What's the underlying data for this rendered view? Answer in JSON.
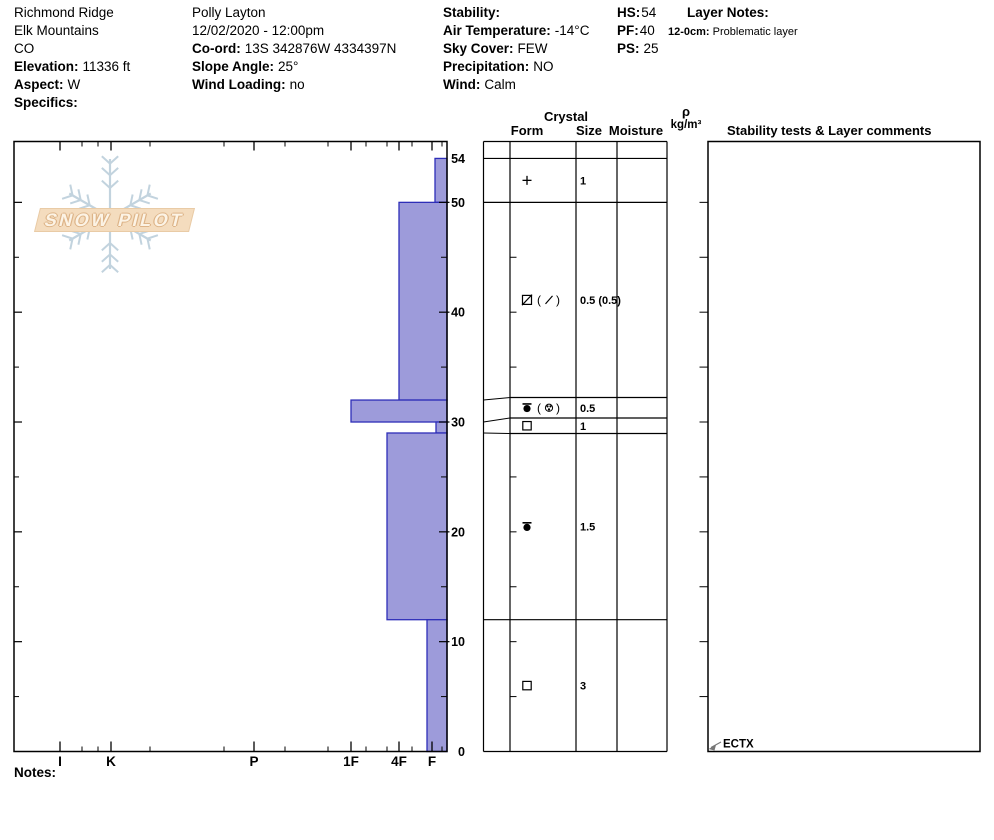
{
  "header": {
    "location": {
      "name": "Richmond Ridge",
      "range": "Elk Mountains",
      "state": "CO",
      "elevation_label": "Elevation:",
      "elevation": "11336 ft",
      "aspect_label": "Aspect:",
      "aspect": "W",
      "specifics_label": "Specifics:",
      "specifics": ""
    },
    "observer": {
      "name": "Polly Layton",
      "datetime": "12/02/2020 - 12:00pm",
      "coord_label": "Co-ord:",
      "coord": "13S 342876W 4334397N",
      "slope_angle_label": "Slope Angle:",
      "slope_angle": "25°",
      "wind_loading_label": "Wind Loading:",
      "wind_loading": "no"
    },
    "conditions": {
      "stability_label": "Stability:",
      "stability": "",
      "air_temp_label": "Air Temperature:",
      "air_temp": "-14°C",
      "sky_cover_label": "Sky Cover:",
      "sky_cover": "FEW",
      "precipitation_label": "Precipitation:",
      "precipitation": "NO",
      "wind_label": "Wind:",
      "wind": "Calm"
    },
    "snowpack": {
      "hs_label": "HS:",
      "hs": "54",
      "pf_label": "PF:",
      "pf": "40",
      "ps_label": "PS:",
      "ps": "25"
    },
    "layer_notes": {
      "title": "Layer Notes:",
      "notes": [
        {
          "range": "12-0cm:",
          "text": "Problematic layer"
        }
      ]
    }
  },
  "profile_table": {
    "crystal": "Crystal",
    "form": "Form",
    "size": "Size",
    "moisture": "Moisture",
    "rho": "ρ",
    "rho_units": "kg/m³",
    "stability_header": "Stability tests & Layer comments"
  },
  "footer": {
    "notes_label": "Notes:"
  },
  "logo": {
    "text": "SNOW PILOT"
  },
  "chart_data": {
    "type": "bar",
    "subtype": "snow-hardness-profile",
    "title": "",
    "xlabel": "Hand hardness (I K P 1F 4F F)",
    "ylabel": "Depth (cm)",
    "grid": false,
    "legend": false,
    "depth_axis": {
      "unit": "cm",
      "surface_cm": 54,
      "ground_cm": 0,
      "tick_labels": [
        "54",
        "50",
        "40",
        "30",
        "20",
        "10",
        "0"
      ],
      "minor_tick_step_cm": 5
    },
    "hardness_axis": {
      "categories": [
        "I",
        "K",
        "P",
        "1F",
        "4F",
        "F"
      ],
      "positions_px": [
        60,
        111,
        254,
        351,
        399,
        432
      ],
      "minor_ticks_px": [
        82,
        98,
        150,
        224,
        285,
        328,
        366,
        387,
        412,
        442
      ],
      "zero_px": 447,
      "direction": "hard-left-soft-right"
    },
    "layers": [
      {
        "top_cm": 54,
        "bottom_cm": 50,
        "hardness": "F",
        "bar_left_px": 435,
        "form": "PP",
        "form_secondary": null,
        "grain_size_mm": "1"
      },
      {
        "top_cm": 50,
        "bottom_cm": 32,
        "hardness": "4F",
        "bar_left_px": 399,
        "form": "DF",
        "form_secondary": "PP",
        "grain_size_mm": "0.5 (0.5)"
      },
      {
        "top_cm": 32,
        "bottom_cm": 30,
        "hardness": "1F",
        "bar_left_px": 351,
        "form": "RG",
        "form_secondary": "RGmx",
        "grain_size_mm": "0.5"
      },
      {
        "top_cm": 30,
        "bottom_cm": 29,
        "hardness": "F",
        "bar_left_px": 436,
        "form": "FC",
        "form_secondary": null,
        "grain_size_mm": "1"
      },
      {
        "top_cm": 29,
        "bottom_cm": 12,
        "hardness": "4F+",
        "bar_left_px": 387,
        "form": "RG",
        "form_secondary": null,
        "grain_size_mm": "1.5"
      },
      {
        "top_cm": 12,
        "bottom_cm": 0,
        "hardness": "F+",
        "bar_left_px": 427,
        "form": "FC",
        "form_secondary": null,
        "grain_size_mm": "3"
      }
    ],
    "stability_tests": [
      {
        "result": "ECTX",
        "depth_cm": 0
      }
    ],
    "colors": {
      "bar_fill": "#9d9bda",
      "bar_stroke": "#2e2eb8",
      "watermark_flake": "#c2d3de",
      "watermark_banner": "#f4dcbe"
    }
  }
}
